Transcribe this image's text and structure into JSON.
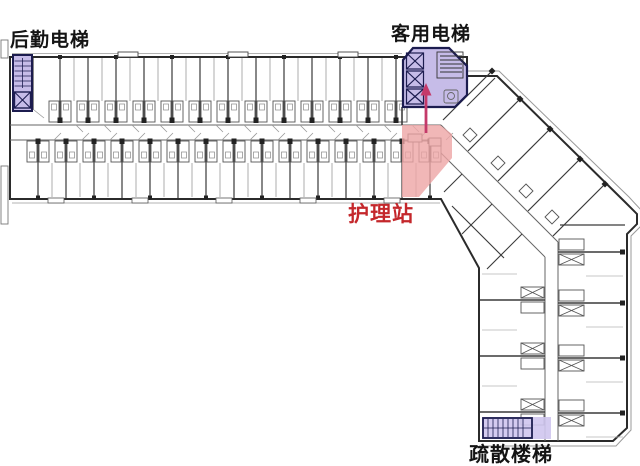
{
  "plan": {
    "labels": {
      "service_elevator": "后勤电梯",
      "guest_elevator": "客用电梯",
      "nursing_station": "护理站",
      "evacuation_stair": "疏散楼梯"
    },
    "colors": {
      "elevator_highlight": "#c6bce8",
      "stair_highlight": "#cfc5ee",
      "nursing_highlight": "#eda5a5",
      "nursing_label": "#c4272b",
      "arrow": "#c43a6a",
      "label_text": "#141414"
    }
  }
}
